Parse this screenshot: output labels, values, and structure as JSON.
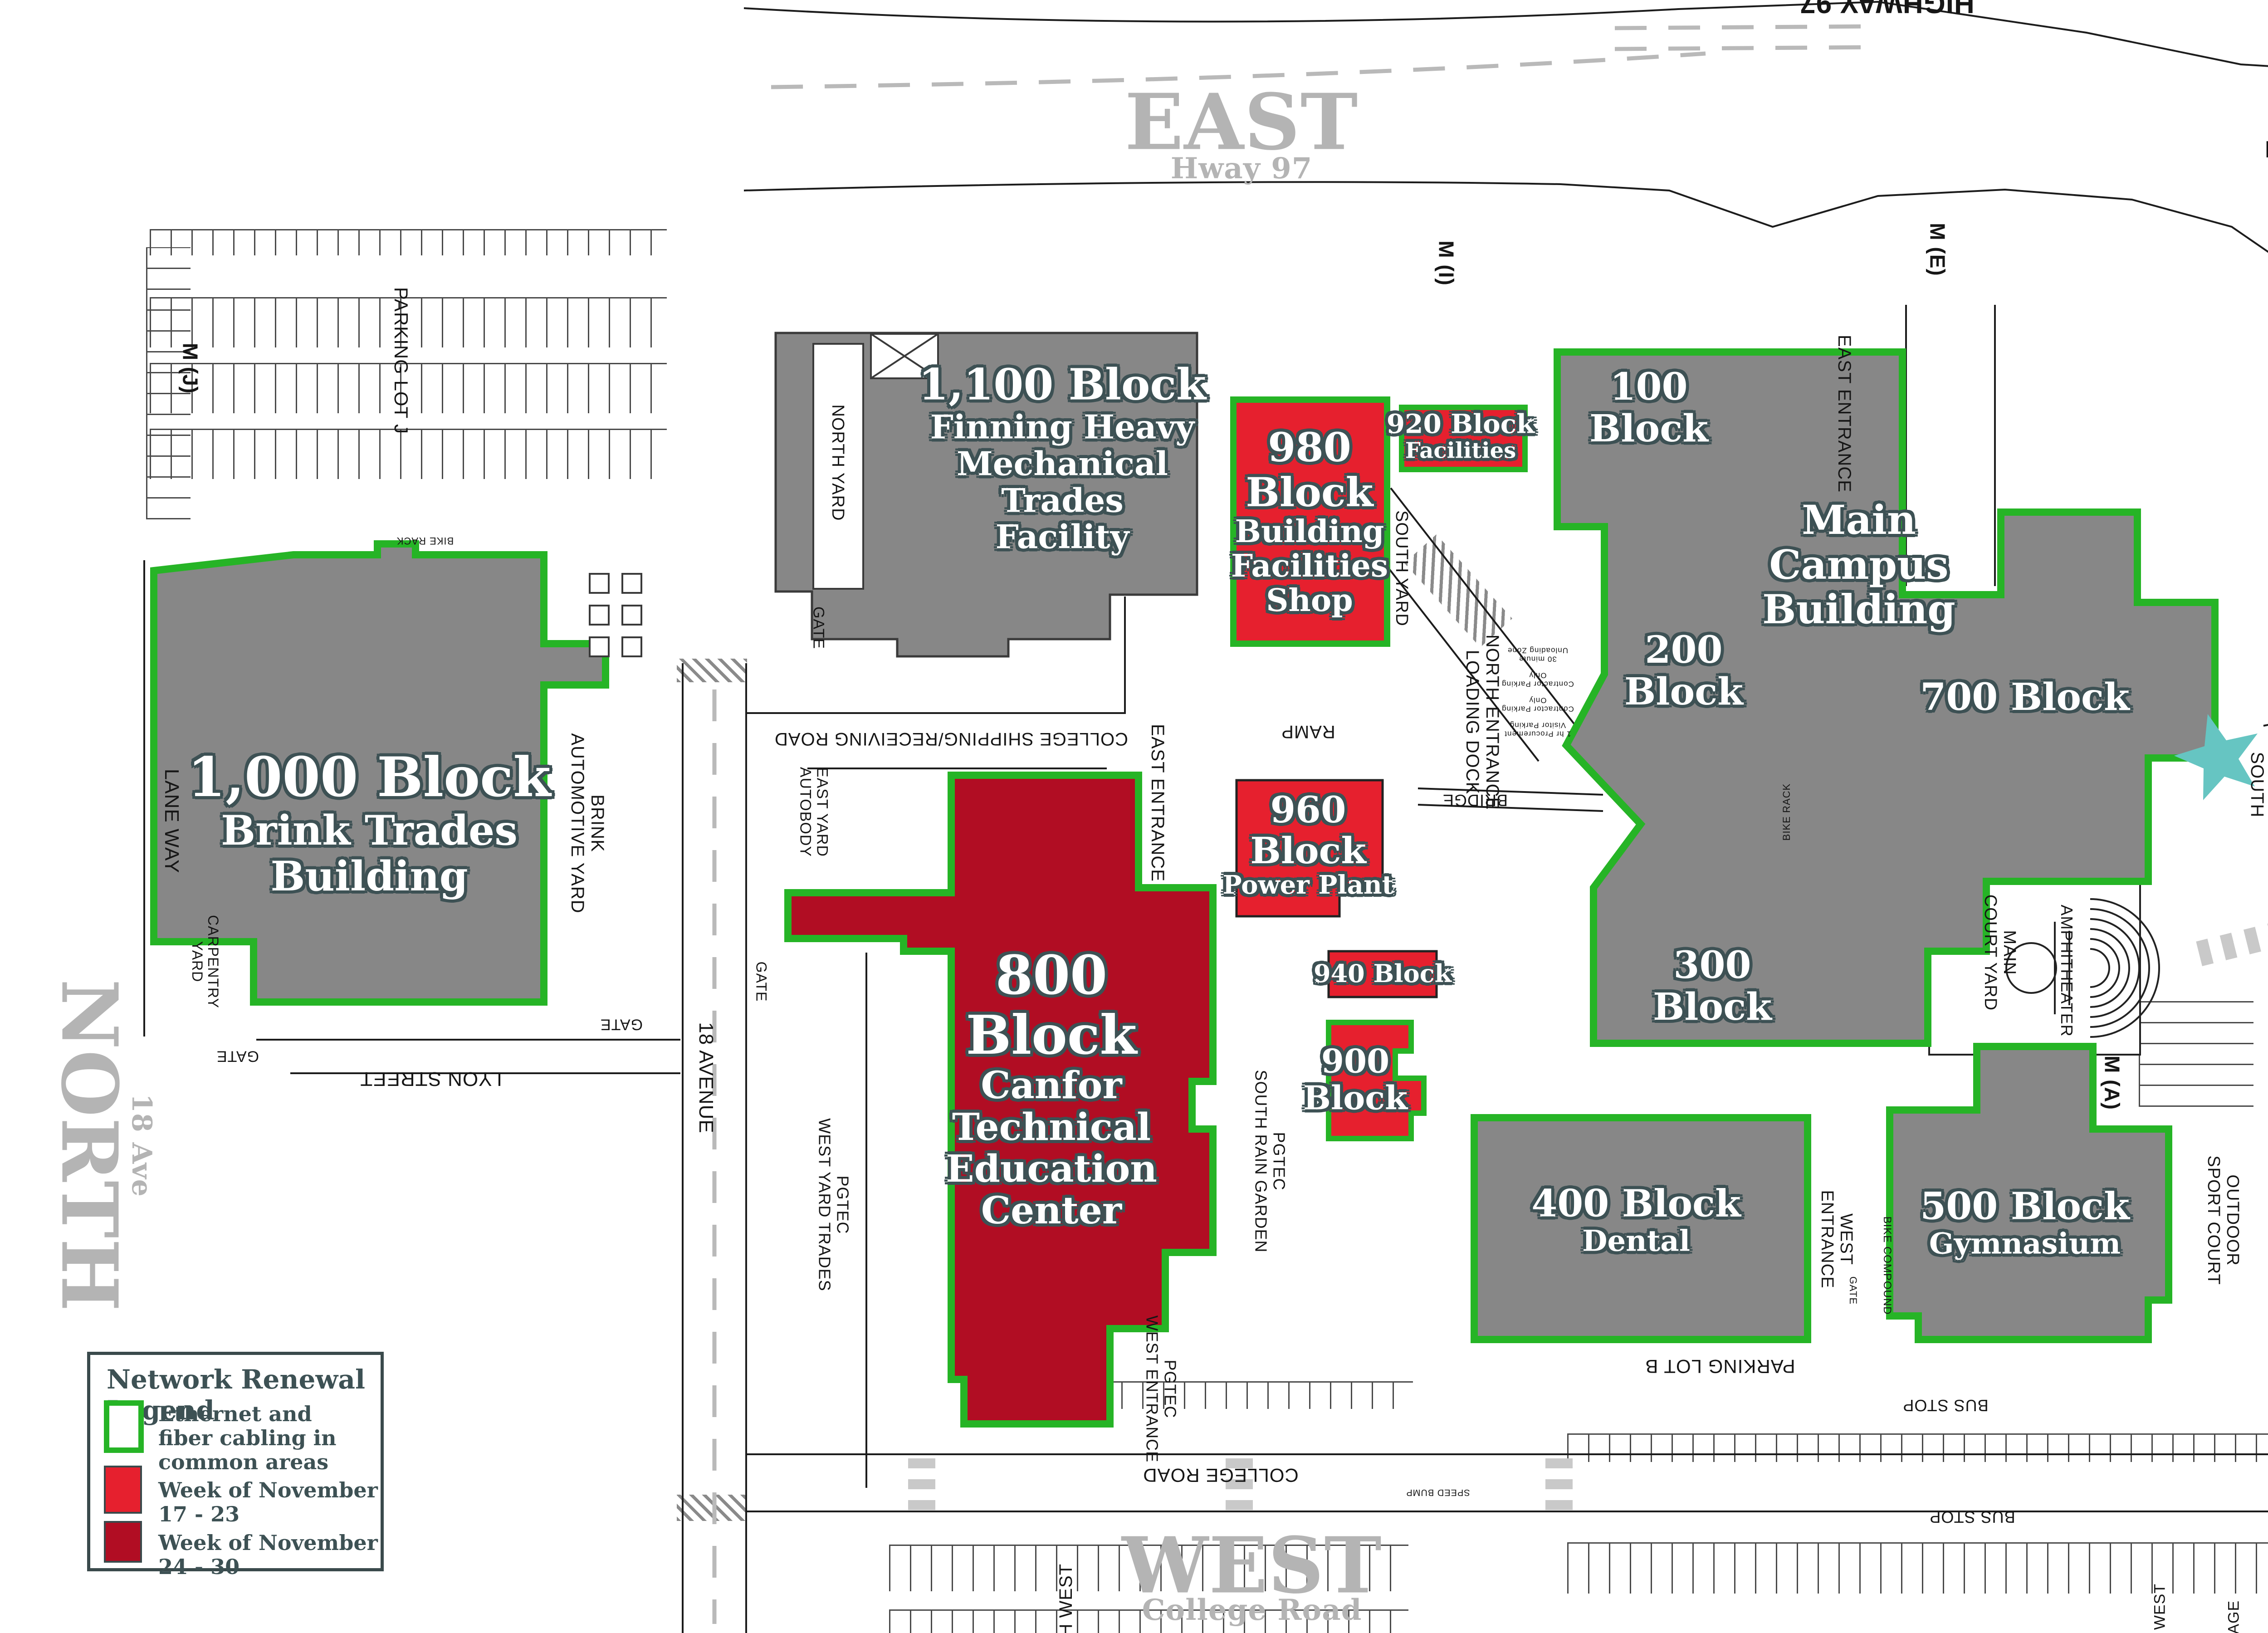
{
  "colors": {
    "green": "#26b426",
    "red": "#e6202e",
    "dark_red": "#b10d23",
    "building_gray": "#878787",
    "label_outline": "#3d5154",
    "direction_gray": "#b4b4b4",
    "teal": "#66c5c2"
  },
  "legend": {
    "title": "Network Renewal Legend",
    "items": [
      {
        "label": "Ethernet and fiber cabling in common areas",
        "swatch": "outline-green"
      },
      {
        "label": "Week of November 17 - 23",
        "swatch": "red"
      },
      {
        "label": "Week of November 24 - 30",
        "swatch": "dark-red"
      }
    ]
  },
  "compass": {
    "n": "N",
    "e": "E",
    "s": "S",
    "w": "W"
  },
  "directions": {
    "east": {
      "title": "EAST",
      "subtitle": "Hway 97"
    },
    "south": {
      "title": "SOUTH",
      "subtitle": "22 Ave"
    },
    "north": {
      "title": "NORTH",
      "subtitle": "18 Ave"
    },
    "west": {
      "title": "WEST",
      "subtitle": "College Road"
    }
  },
  "buildings": {
    "b1000": {
      "lines": [
        "1,000 Block",
        "Brink Trades",
        "Building"
      ]
    },
    "b1100": {
      "lines": [
        "1,100 Block",
        "Finning Heavy",
        "Mechanical",
        "Trades",
        "Facility"
      ]
    },
    "b980": {
      "lines": [
        "980",
        "Block",
        "Building",
        "Facilities",
        "Shop"
      ]
    },
    "b960": {
      "lines": [
        "960",
        "Block",
        "Power Plant"
      ]
    },
    "b940": {
      "lines": [
        "940 Block"
      ]
    },
    "b920": {
      "lines": [
        "920 Block",
        "Facilities"
      ]
    },
    "b900": {
      "lines": [
        "900",
        "Block"
      ]
    },
    "b800": {
      "lines": [
        "800",
        "Block",
        "Canfor",
        "Technical",
        "Education",
        "Center"
      ]
    },
    "b100": {
      "lines": [
        "100",
        "Block"
      ]
    },
    "main": {
      "lines": [
        "Main",
        "Campus",
        "Building"
      ]
    },
    "b200": {
      "lines": [
        "200",
        "Block"
      ]
    },
    "b700": {
      "lines": [
        "700 Block"
      ]
    },
    "b300": {
      "lines": [
        "300",
        "Block"
      ]
    },
    "b400": {
      "lines": [
        "400 Block",
        "Dental"
      ]
    },
    "b500": {
      "lines": [
        "500 Block",
        "Gymnasium"
      ]
    }
  },
  "labels": {
    "highway97": "HIGHWAY 97",
    "m_j": "M (J)",
    "m_i": "M (I)",
    "m_e": "M (E)",
    "m_a": "M (A)",
    "parking_lot_j": "PARKING LOT J",
    "parking_lot_b": "PARKING LOT B",
    "bus_stop": "BUS STOP",
    "north_yard": "NORTH YARD",
    "south_yard": "SOUTH YARD",
    "east_entrance": "EAST ENTRANCE",
    "north_entrance": "NORTH ENTRANCE",
    "loading_dock": "LOADING DOCK",
    "bridge": "BRIDGE",
    "ramp": "RAMP",
    "college_shipping": "COLLEGE SHIPPING/RECEIVING ROAD",
    "gate": "GATE",
    "east_yard": "EAST YARD",
    "autobody": "AUTOBODY",
    "lane_way": "LANE WAY",
    "brink": "BRINK",
    "automotive_yard": "AUTOMOTIVE YARD",
    "carpentry": "CARPENTRY",
    "yard": "YARD",
    "lyon_street": "LYON STREET",
    "avenue18": "18 AVENUE",
    "pgtec": "PGTEC",
    "west_yard_trades": "WEST YARD TRADES",
    "south_rain_garden": "SOUTH RAIN GARDEN",
    "west_entrance_sub": "WEST ENTRANCE",
    "college_road": "COLLEGE ROAD",
    "west_word": "WEST",
    "entrance_word": "ENTRANCE",
    "bike_compound": "BIKE COMPOUND",
    "bike_rack": "BIKE RACK",
    "main_word": "MAIN",
    "court_yard": "COURT YARD",
    "amphitheater": "AMPHITHEATER",
    "outdoor": "OUTDOOR",
    "sport_court": "SPORT COURT",
    "main_entrance": "MAIN ENTRANCE",
    "south_word": "SOUTH",
    "speed_bump": "SPEED BUMP",
    "zone_30min": "30 minute Unloading Zone",
    "zone_contractor": "Contractor Parking Only",
    "zone_procurement": "1 hr Procurement Visitor Parking",
    "frag_rth_west": "RTH WEST",
    "frag_c_west": "C WEST",
    "frag_rage": "RAGE"
  }
}
